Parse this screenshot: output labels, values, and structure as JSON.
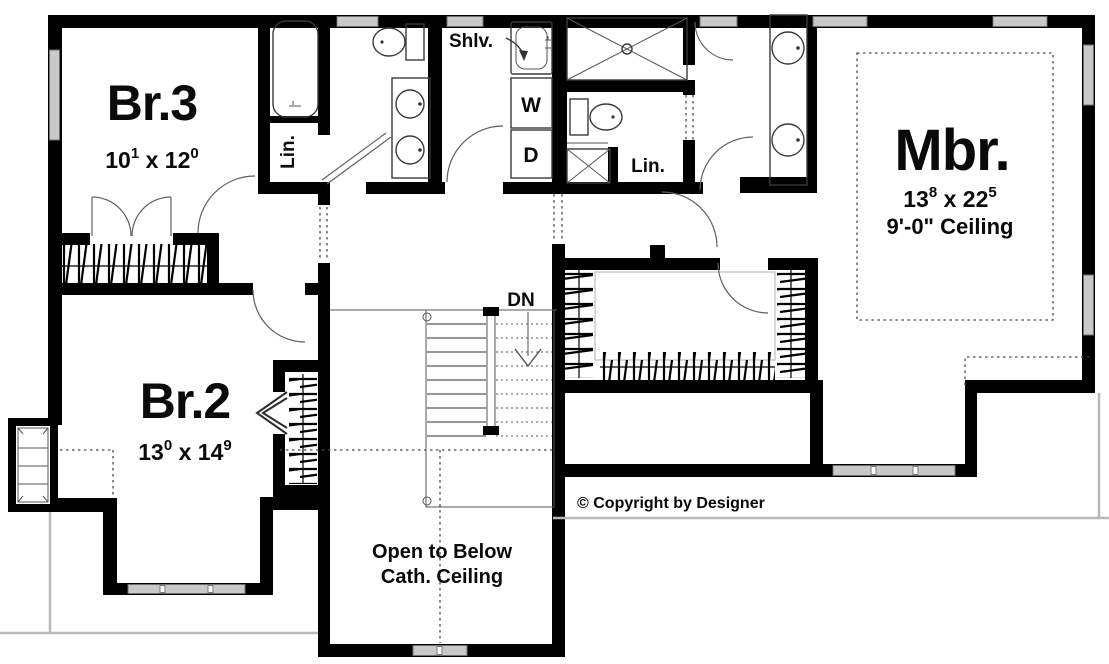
{
  "plan": {
    "rooms": {
      "br3": {
        "name": "Br.3",
        "w_ft": "10",
        "w_in": "1",
        "sep": " x ",
        "l_ft": "12",
        "l_in": "0"
      },
      "br2": {
        "name": "Br.2",
        "w_ft": "13",
        "w_in": "0",
        "sep": " x ",
        "l_ft": "14",
        "l_in": "9"
      },
      "mbr": {
        "name": "Mbr.",
        "w_ft": "13",
        "w_in": "8",
        "sep": " x ",
        "l_ft": "22",
        "l_in": "5",
        "ceiling": "9'-0\" Ceiling"
      }
    },
    "labels": {
      "shelves": "Shlv.",
      "washer": "W",
      "dryer": "D",
      "linen_hall": "Lin.",
      "linen_master": "Lin.",
      "down": "DN",
      "open_below_1": "Open to Below",
      "open_below_2": "Cath. Ceiling"
    },
    "copyright": "© Copyright by Designer",
    "colors": {
      "wall": "#000000",
      "window": "#c9c9c9",
      "dashed_line": "#4a4a4a"
    }
  }
}
